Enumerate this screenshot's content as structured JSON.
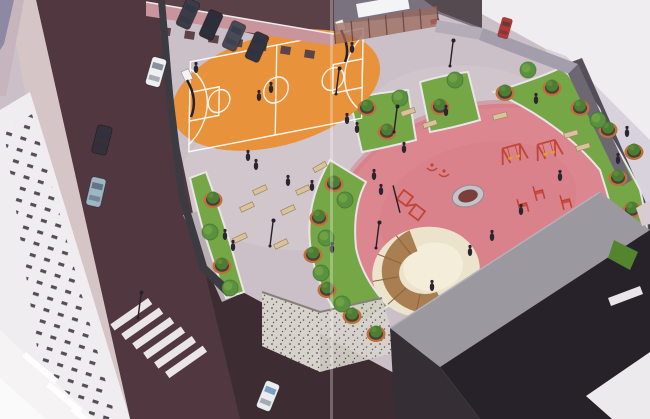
{
  "meta": {
    "image_type": "3d-aerial-architectural-rendering",
    "scene": "urban pocket park with basketball court, planted plaza and children playground"
  },
  "colors": {
    "paving": "#cbc0c7",
    "pavingLight": "#d8cdd2",
    "street": "#513840",
    "streetDark": "#3a2b31",
    "sidewalk": "#d6c5c7",
    "sidewalk2": "#c6b5bc",
    "roofPurple": "#8e89a2",
    "whiteBldg": "#f0edf0",
    "bldgShade": "#d8d2dc",
    "window": "#3a333e",
    "northStrip": "#7b7280",
    "whiteRoof": "#f4f3f6",
    "darkMass": "#564a51",
    "redAccent": "#a83a32",
    "pinkWall": "#c8959c",
    "fence": "#9b6a5c",
    "fencePost": "#6b4a42",
    "wallLight": "#b4adb8",
    "wallLight2": "#a49dab",
    "eastWall": "#6d6772",
    "shadowBand": "#453e49",
    "wallDark": "#3c3b42",
    "gabion": "#d7d3cc",
    "gabionDot": "#5a544f",
    "court": "#e8923c",
    "courtLine": "#ffffff",
    "grass": "#76a746",
    "grassDark": "#55842f",
    "playground": "#dc8690",
    "playgroundDark": "#d47a86",
    "sand": "#ece3cd",
    "sandLight": "#f4edda",
    "wood": "#a97e50",
    "woodDark": "#8a6440",
    "pot": "#474038",
    "rim": "#bf6f3c",
    "bush": "#4d7c33",
    "tree": "#5a9140",
    "treeDark": "#3e6d29",
    "equip": "#c04534",
    "seat": "#dfa02c",
    "bench": "#d9c39c",
    "benchEdge": "#9f8662",
    "metal": "#26222a",
    "person": "#2b2530",
    "crosswalk": "#f2eff0",
    "roofGray": "#9c98a0",
    "darkBldg": "#272129",
    "darkBldg2": "#352e35",
    "ringGray": "#c6c2c9",
    "ringCenter": "#7a3f3a",
    "curb": "#b9aeb2"
  },
  "scene": {
    "planters": [
      [
        213,
        200
      ],
      [
        222,
        266
      ],
      [
        334,
        184
      ],
      [
        319,
        218
      ],
      [
        313,
        255
      ],
      [
        327,
        290
      ],
      [
        352,
        316
      ],
      [
        376,
        334
      ],
      [
        367,
        108
      ],
      [
        387,
        132
      ],
      [
        440,
        107
      ],
      [
        505,
        93
      ],
      [
        552,
        88
      ],
      [
        580,
        108
      ],
      [
        608,
        130
      ],
      [
        634,
        152
      ],
      [
        618,
        178
      ],
      [
        632,
        210
      ],
      [
        643,
        243
      ]
    ],
    "trees": [
      [
        210,
        232
      ],
      [
        230,
        288
      ],
      [
        345,
        200
      ],
      [
        326,
        238
      ],
      [
        321,
        273
      ],
      [
        342,
        304
      ],
      [
        400,
        98
      ],
      [
        455,
        80
      ],
      [
        528,
        70
      ],
      [
        598,
        120
      ],
      [
        645,
        264
      ]
    ],
    "people": [
      [
        196,
        69
      ],
      [
        259,
        97
      ],
      [
        271,
        89
      ],
      [
        352,
        49
      ],
      [
        347,
        120
      ],
      [
        357,
        129
      ],
      [
        248,
        157
      ],
      [
        256,
        166
      ],
      [
        288,
        182
      ],
      [
        312,
        187
      ],
      [
        374,
        176
      ],
      [
        381,
        191
      ],
      [
        404,
        149
      ],
      [
        225,
        236
      ],
      [
        233,
        247
      ],
      [
        332,
        249
      ],
      [
        446,
        112
      ],
      [
        560,
        177
      ],
      [
        521,
        211
      ],
      [
        492,
        237
      ],
      [
        470,
        252
      ],
      [
        497,
        316
      ],
      [
        536,
        100
      ],
      [
        627,
        133
      ],
      [
        618,
        160
      ],
      [
        432,
        287
      ]
    ],
    "benches": [
      [
        260,
        190,
        -25
      ],
      [
        303,
        190,
        -25
      ],
      [
        247,
        207,
        -25
      ],
      [
        288,
        210,
        -25
      ],
      [
        240,
        238,
        -25
      ],
      [
        281,
        244,
        -25
      ],
      [
        320,
        167,
        -30
      ],
      [
        430,
        124,
        -18
      ],
      [
        500,
        116,
        -14
      ],
      [
        571,
        134,
        -16
      ],
      [
        583,
        147,
        -16
      ],
      [
        408,
        112,
        -18
      ]
    ],
    "lamps": [
      [
        270,
        246
      ],
      [
        376,
        248
      ],
      [
        138,
        318
      ],
      [
        336,
        94
      ],
      [
        450,
        66
      ],
      [
        394,
        132
      ]
    ],
    "cars": [
      {
        "x": 156,
        "y": 72,
        "a": 16,
        "c": "#eef0f2"
      },
      {
        "x": 102,
        "y": 140,
        "a": 14,
        "c": "#35303a"
      },
      {
        "x": 96,
        "y": 192,
        "a": 13,
        "c": "#9db6c4"
      },
      {
        "x": 268,
        "y": 396,
        "a": 22,
        "c": "#e9edf0",
        "two": true
      },
      {
        "x": 188,
        "y": 14,
        "a": 24,
        "c": "#3c3c46"
      },
      {
        "x": 211,
        "y": 25,
        "a": 24,
        "c": "#2e2e38"
      },
      {
        "x": 234,
        "y": 36,
        "a": 24,
        "c": "#4a4a55"
      },
      {
        "x": 257,
        "y": 47,
        "a": 24,
        "c": "#34343e"
      },
      {
        "x": 505,
        "y": 28,
        "a": 16,
        "c": "#b23a35",
        "s": 0.7
      }
    ],
    "swings": [
      [
        513,
        153,
        -15
      ],
      [
        548,
        149,
        -15
      ]
    ],
    "springers": [
      [
        523,
        206
      ],
      [
        539,
        193
      ],
      [
        566,
        202
      ]
    ],
    "rockers": [
      [
        432,
        165
      ],
      [
        444,
        171
      ]
    ],
    "climber": {
      "x": 412,
      "y": 205,
      "r": -8
    },
    "ring": {
      "x": 468,
      "y": 196,
      "r": -14
    },
    "sandpit": {
      "x": 426,
      "y": 272,
      "r": -10
    },
    "crosswalk": {
      "x": 148,
      "y": 298,
      "angle": 41,
      "count": 6,
      "step": 14.5,
      "w": 7.5,
      "h": 46,
      "rot": 14
    },
    "wall_doors": [
      160,
      184,
      208,
      232,
      256,
      280,
      304
    ],
    "fence": {
      "x1": 334,
      "y1": 24,
      "x2": 437,
      "y2": 6,
      "base1": 44,
      "base2": 26,
      "posts": 7
    }
  }
}
